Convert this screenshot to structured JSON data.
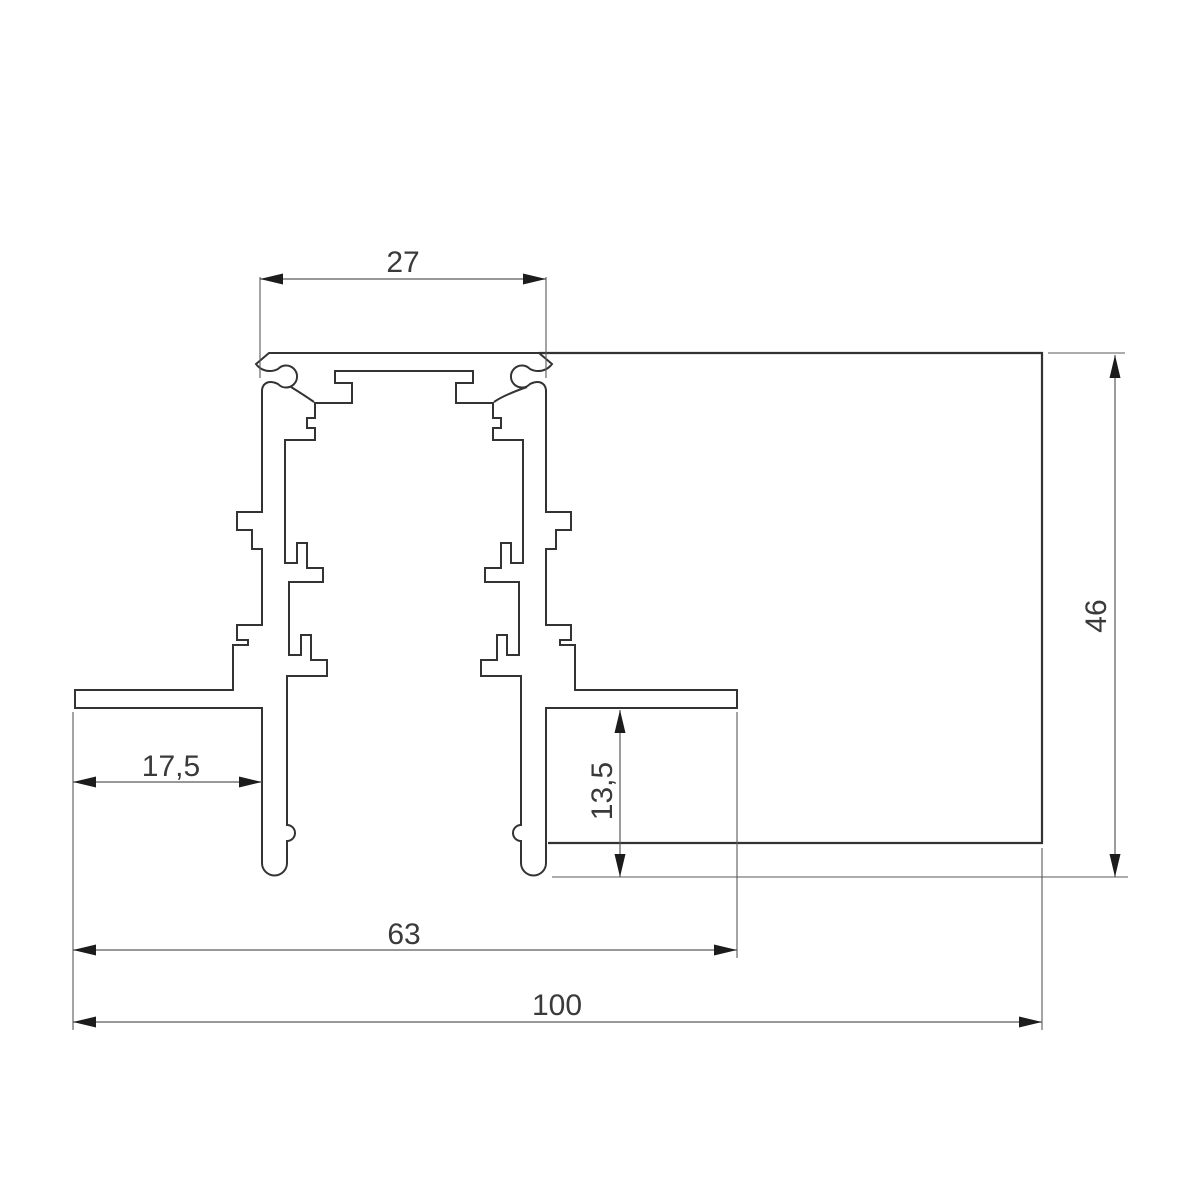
{
  "drawing": {
    "kind": "technical-cross-section",
    "units_shown": false
  },
  "dimensions": {
    "top_width": "27",
    "right_height": "46",
    "left_flange_width": "17,5",
    "lower_depth": "13,5",
    "flange_span": "63",
    "total_width": "100"
  },
  "colors": {
    "bg": "#ffffff",
    "profile_line": "#333333",
    "dim_line": "#5a5a5a",
    "arrow": "#1c1c1c",
    "text": "#3a3a3a"
  }
}
